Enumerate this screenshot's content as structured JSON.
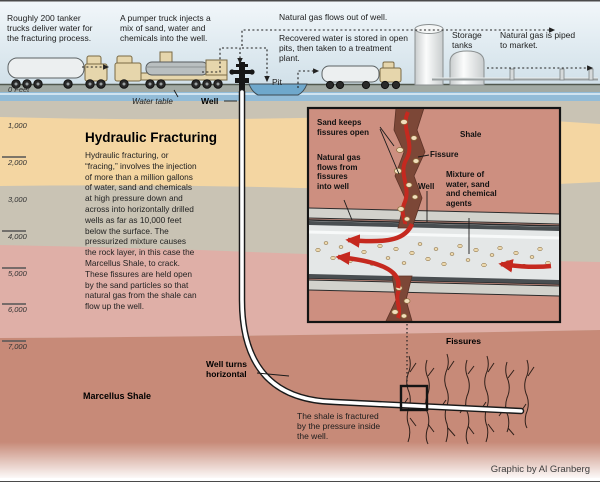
{
  "title": "Hydraulic Fracturing",
  "body": "Hydraulic fracturing, or\n“fracing,” involves the injection\nof more than a million gallons\nof water, sand and chemicals\nat high pressure down and\nacross into horizontally drilled\nwells as far as 10,000 feet\nbelow the surface. The\npressurized mixture causes\nthe rock layer, in this case the\nMarcellus Shale, to crack.\nThese fissures are held open\nby the sand particles so that\nnatural gas from the shale can\nflow up the well.",
  "surface": {
    "tanker_note": "Roughly 200 tanker\ntrucks deliver water for\nthe fracturing process.",
    "pumper_note": "A pumper truck injects a\nmix of sand, water and\nchemicals into the well.",
    "gas_out_note": "Natural gas flows out of well.",
    "recovered_note": "Recovered water is stored in open\npits, then taken to a treatment\nplant.",
    "storage_label": "Storage\ntanks",
    "piped_note": "Natural gas is piped\nto market.",
    "pit_label": "Pit",
    "well_label": "Well",
    "water_table_label": "Water table"
  },
  "depth_scale": {
    "labels": [
      "0 Feet",
      "1,000",
      "2,000",
      "3,000",
      "4,000",
      "5,000",
      "6,000",
      "7,000"
    ]
  },
  "inset": {
    "sand_keeps": "Sand keeps\nfissures open",
    "shale": "Shale",
    "fissure": "Fissure",
    "gas_flows": "Natural gas\nflows from\nfissures\ninto well",
    "well": "Well",
    "mixture": "Mixture of\nwater, sand\nand chemical\nagents"
  },
  "deep": {
    "well_turns": "Well turns\nhorizontal",
    "marcellus": "Marcellus Shale",
    "fissures": "Fissures",
    "fractured_note": "The shale is fractured\nby the pressure inside\nthe well."
  },
  "credit": "Graphic by Al Granberg",
  "colors": {
    "sky": "#e6eff4",
    "strata_gray": "#c9c3b4",
    "strata_tan": "#f4d6a2",
    "strata_pink": "#dfafa7",
    "marcellus_salmon": "#c78a78",
    "water_blue": "#92bcd8",
    "inset_bg": "#cd8f80",
    "fissure_brown": "#7c4737",
    "flow_red": "#c5291f",
    "sand": "#f1debc",
    "pipe_gray": "#e4e7e7"
  }
}
